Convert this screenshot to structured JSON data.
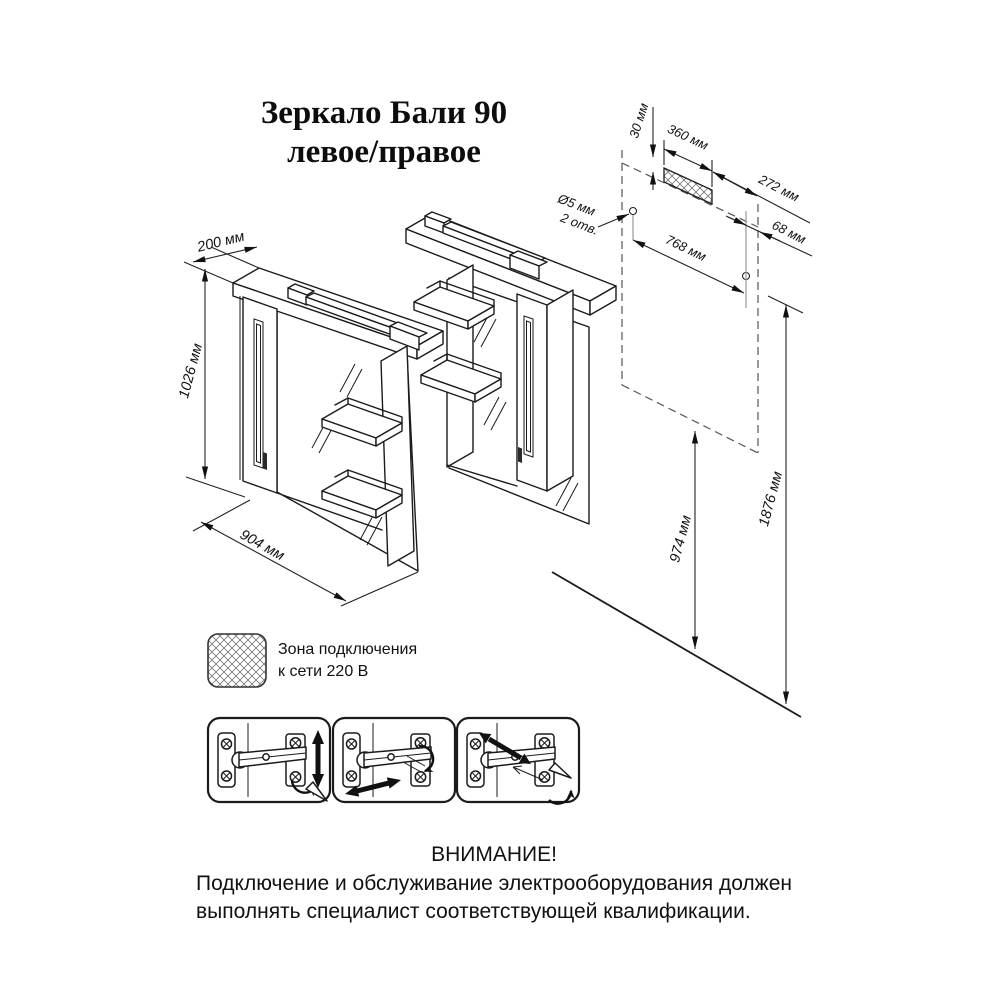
{
  "title": {
    "line1": "Зеркало Бали 90",
    "line2": "левое/правое"
  },
  "dims": {
    "depth": "200 мм",
    "height": "1026 мм",
    "width": "904 мм",
    "zone_offset": "30 мм",
    "zone_width": "360 мм",
    "hole_dia": "Ø5 мм",
    "hole_count": "2 отв.",
    "hole_spacing": "768 мм",
    "offset_right": "272 мм",
    "offset_edge": "68 мм",
    "bottom_height": "974 мм",
    "total_height": "1876 мм"
  },
  "legend": {
    "line1": "Зона подключения",
    "line2": "к сети 220 В"
  },
  "warning": {
    "title": "ВНИМАНИЕ!",
    "line1": "Подключение  и  обслуживание  электрооборудования  должен",
    "line2": "выполнять специалист соответствующей квалификации."
  },
  "colors": {
    "line": "#1b1b1b",
    "dim": "#222222",
    "gray": "#999999",
    "dashed": "#555555",
    "background": "#ffffff"
  }
}
